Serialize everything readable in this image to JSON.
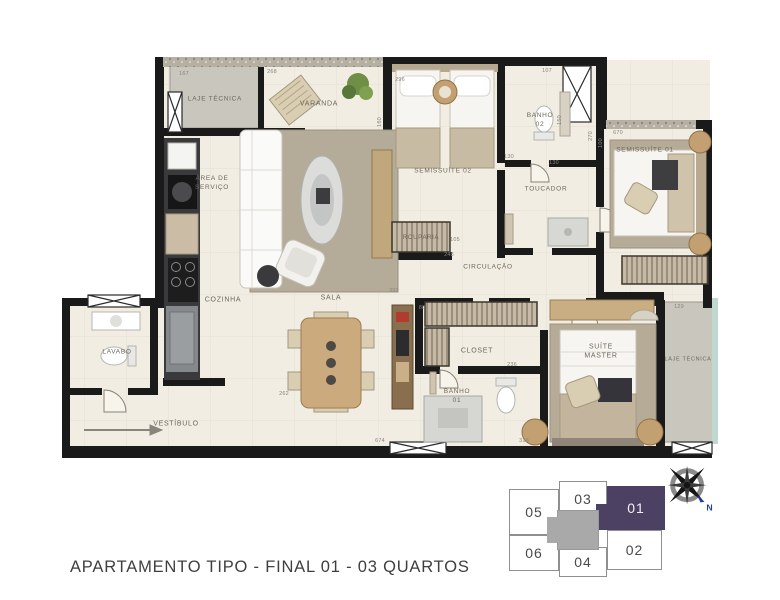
{
  "caption": "APARTAMENTO TIPO - FINAL 01 - 03 QUARTOS",
  "colors": {
    "wall": "#1a1a1a",
    "floor": "#f1ede3",
    "laje_gray": "#c9c6be",
    "teal_edge": "#bfd9d0",
    "highlight_purple": "#4c4063",
    "core_gray": "#a9a9a9",
    "caption_ink": "#3f3f3f",
    "compass_n_blue": "#1f3db0"
  },
  "floorplan": {
    "rooms": [
      {
        "id": "laje-tecnica-top",
        "label": "LAJE TÉCNICA",
        "x": 215,
        "y": 100,
        "fs": 6.5
      },
      {
        "id": "varanda",
        "label": "VARANDA",
        "x": 319,
        "y": 104,
        "fs": 7
      },
      {
        "id": "area-de-servico",
        "label": "ÁREA DE\nSERVIÇO",
        "x": 212,
        "y": 184,
        "fs": 6.5
      },
      {
        "id": "cozinha",
        "label": "COZINHA",
        "x": 223,
        "y": 300,
        "fs": 7
      },
      {
        "id": "sala",
        "label": "SALA",
        "x": 331,
        "y": 298,
        "fs": 7
      },
      {
        "id": "vestibulo",
        "label": "VESTÍBULO",
        "x": 176,
        "y": 424,
        "fs": 7
      },
      {
        "id": "lavabo",
        "label": "LAVABO",
        "x": 117,
        "y": 353,
        "fs": 6.5
      },
      {
        "id": "semissuite-02",
        "label": "SEMISSUÍTE 02",
        "x": 443,
        "y": 172,
        "fs": 6.5
      },
      {
        "id": "rouparia",
        "label": "ROUPARIA",
        "x": 421,
        "y": 238,
        "fs": 6
      },
      {
        "id": "banho-02",
        "label": "BANHO\n02",
        "x": 540,
        "y": 121,
        "fs": 6.5
      },
      {
        "id": "toucador",
        "label": "TOUCADOR",
        "x": 546,
        "y": 190,
        "fs": 6.5
      },
      {
        "id": "semissuite-01",
        "label": "SEMISSUÍTE 01",
        "x": 645,
        "y": 151,
        "fs": 6.5
      },
      {
        "id": "circulacao",
        "label": "CIRCULAÇÃO",
        "x": 488,
        "y": 268,
        "fs": 6.5
      },
      {
        "id": "closet",
        "label": "CLOSET",
        "x": 477,
        "y": 351,
        "fs": 7
      },
      {
        "id": "banho-01",
        "label": "BANHO\n01",
        "x": 457,
        "y": 397,
        "fs": 6.5
      },
      {
        "id": "suite-master",
        "label": "SUÍTE\nMASTER",
        "x": 601,
        "y": 352,
        "fs": 7
      },
      {
        "id": "laje-tecnica-right",
        "label": "LAJE TÉCNICA",
        "x": 688,
        "y": 360,
        "fs": 5.5
      }
    ],
    "dimensions": [
      {
        "t": "167",
        "x": 184,
        "y": 74
      },
      {
        "t": "268",
        "x": 272,
        "y": 72
      },
      {
        "t": "296",
        "x": 400,
        "y": 80
      },
      {
        "t": "107",
        "x": 547,
        "y": 71
      },
      {
        "t": "160",
        "x": 380,
        "y": 122,
        "r": "v"
      },
      {
        "t": "150",
        "x": 560,
        "y": 120,
        "r": "v"
      },
      {
        "t": "100",
        "x": 601,
        "y": 143,
        "r": "v"
      },
      {
        "t": "130",
        "x": 554,
        "y": 163
      },
      {
        "t": "270",
        "x": 591,
        "y": 136,
        "r": "v"
      },
      {
        "t": "670",
        "x": 618,
        "y": 133
      },
      {
        "t": "105",
        "x": 455,
        "y": 240
      },
      {
        "t": "248",
        "x": 449,
        "y": 255
      },
      {
        "t": "393",
        "x": 394,
        "y": 291
      },
      {
        "t": "88",
        "x": 422,
        "y": 308
      },
      {
        "t": "236",
        "x": 512,
        "y": 365
      },
      {
        "t": "262",
        "x": 284,
        "y": 394
      },
      {
        "t": "674",
        "x": 380,
        "y": 441
      },
      {
        "t": "318",
        "x": 524,
        "y": 441
      },
      {
        "t": "129",
        "x": 679,
        "y": 307
      },
      {
        "t": "130",
        "x": 509,
        "y": 157
      }
    ]
  },
  "keyplan": {
    "units": [
      {
        "id": "05",
        "label": "05"
      },
      {
        "id": "03",
        "label": "03"
      },
      {
        "id": "01",
        "label": "01"
      },
      {
        "id": "06",
        "label": "06"
      },
      {
        "id": "04",
        "label": "04"
      },
      {
        "id": "02",
        "label": "02"
      }
    ],
    "highlighted_unit": "01",
    "compass_label": "N"
  }
}
